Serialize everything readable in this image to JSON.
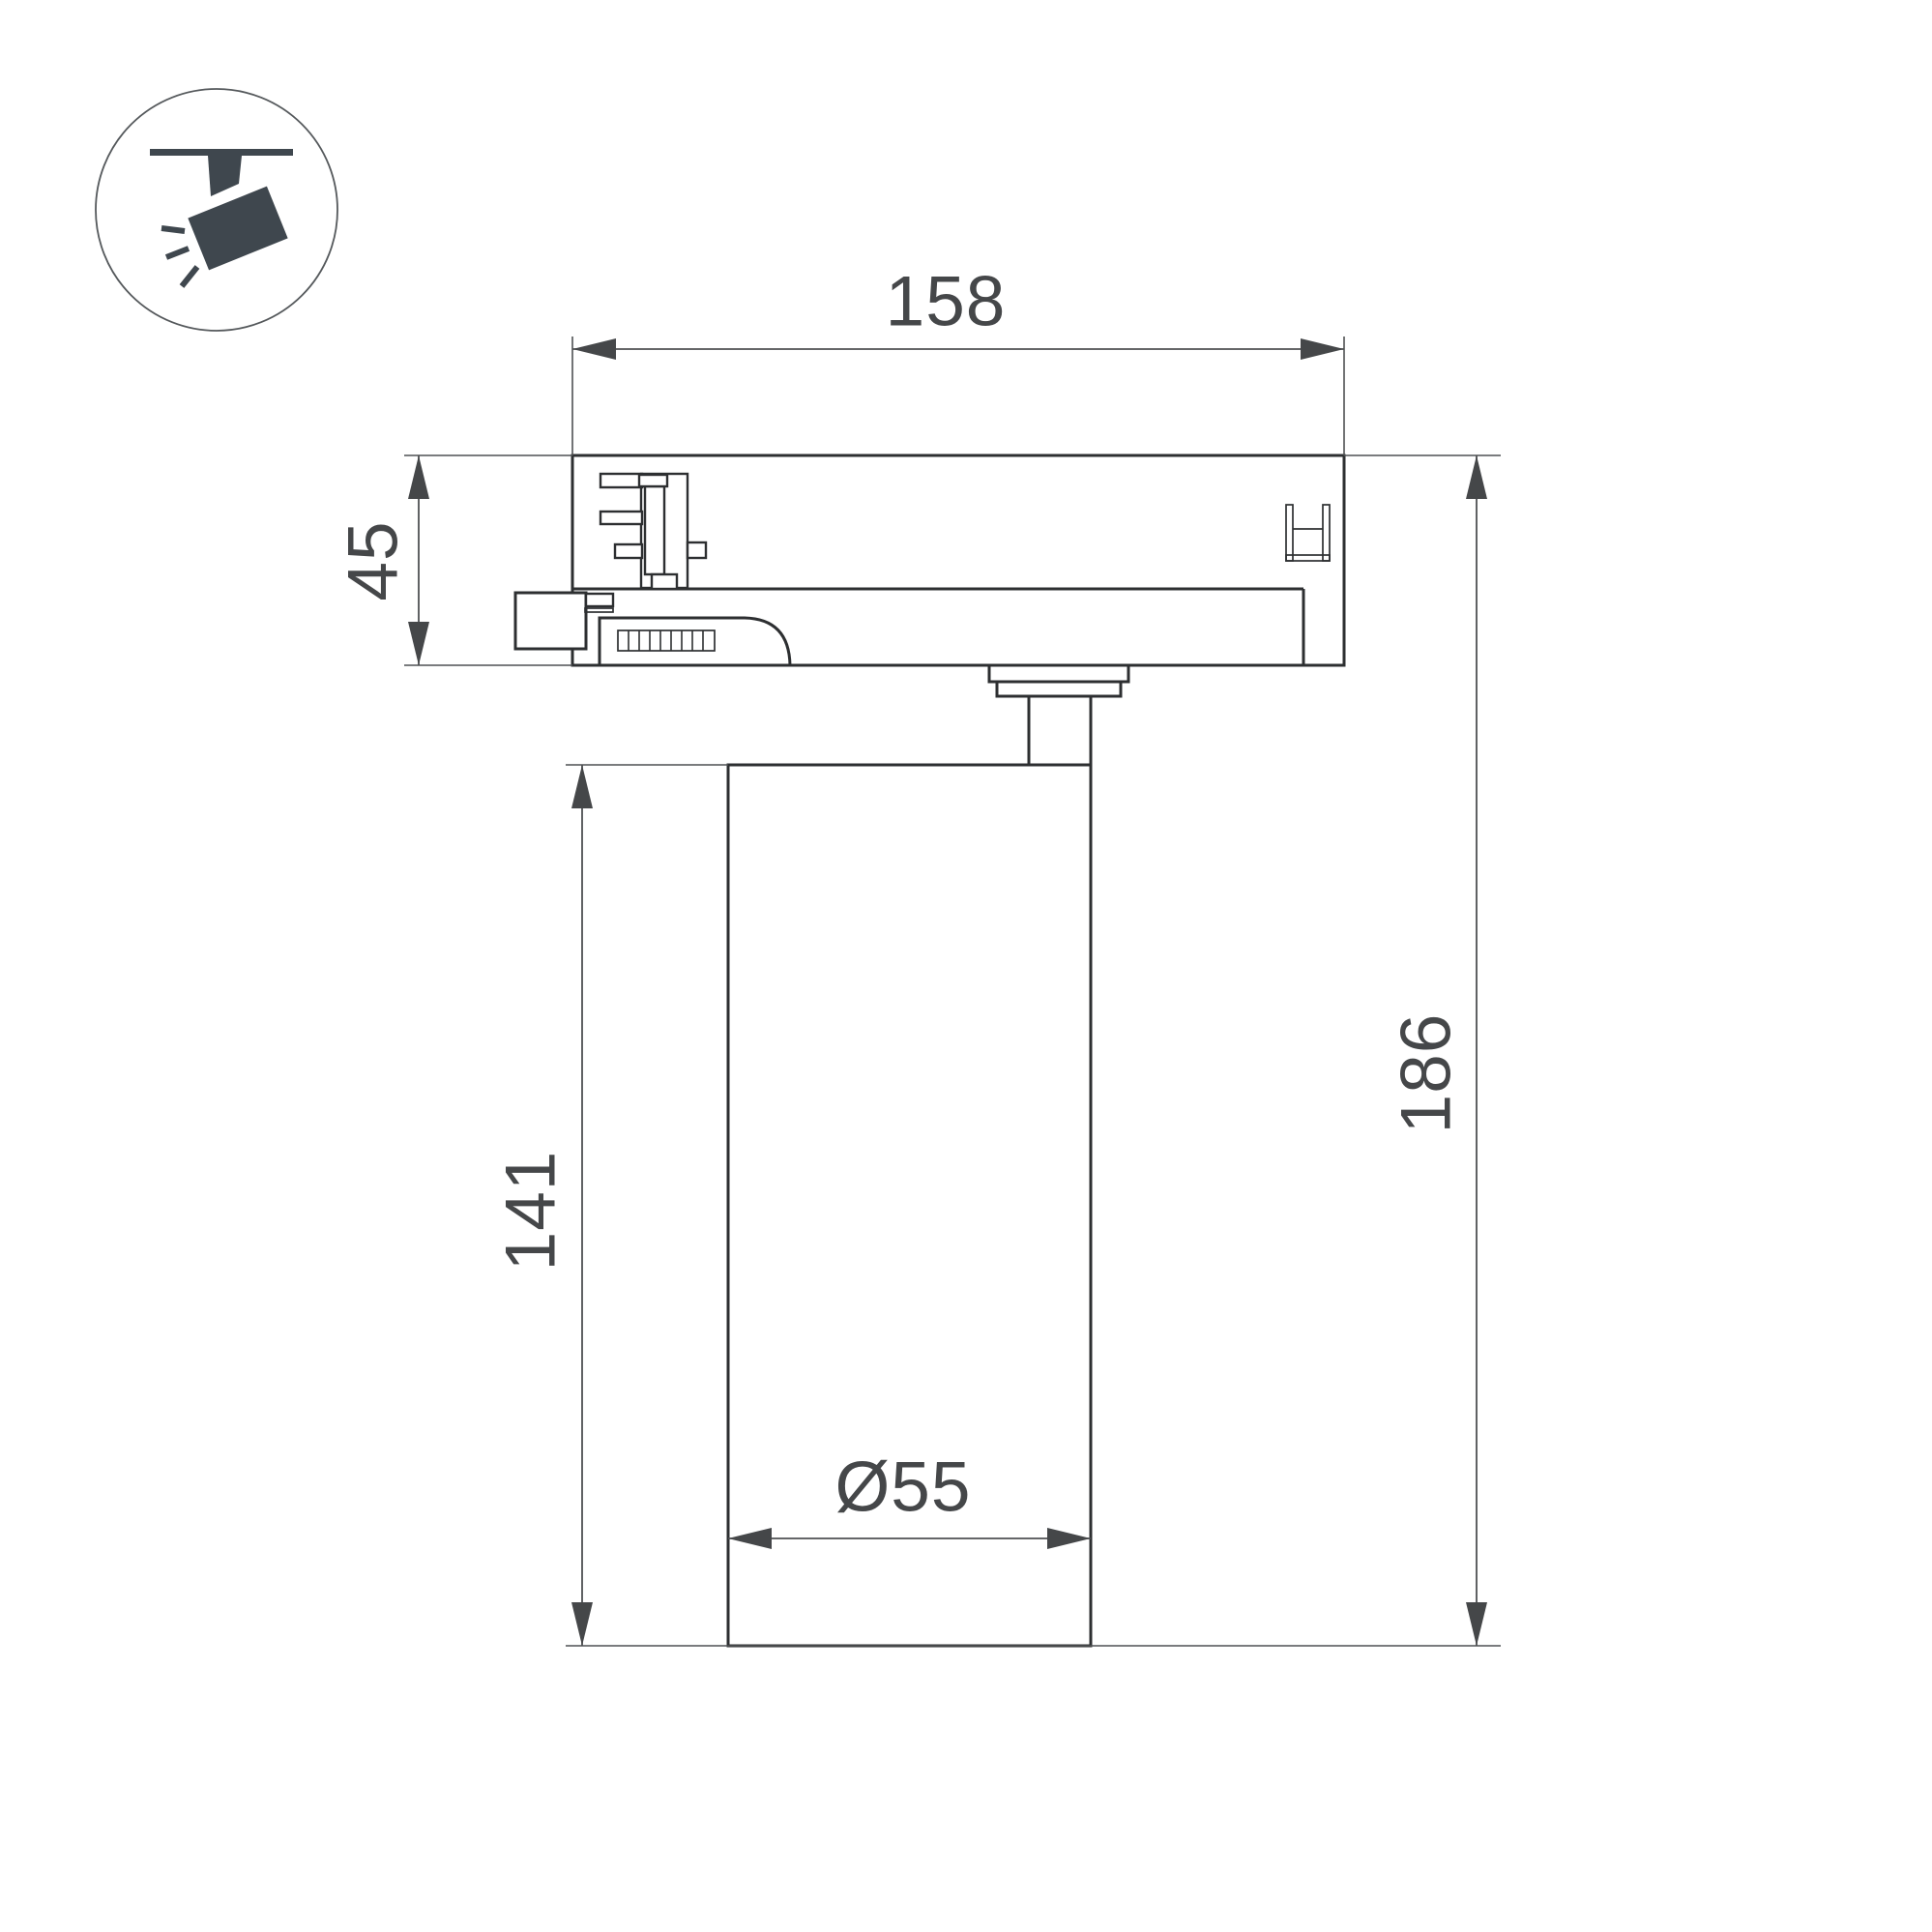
{
  "drawing": {
    "type": "technical-dimension-drawing",
    "subject": "track-mounted cylindrical spotlight, side section view",
    "dimensions": {
      "track_adapter_width": "158",
      "track_adapter_height": "45",
      "lamp_body_height": "141",
      "total_height": "186",
      "lamp_body_diameter": "Ø55"
    }
  },
  "icon": {
    "name": "track-spotlight-icon",
    "description": "ceiling track with tilted spotlight head and light rays, inside circle"
  },
  "colors": {
    "background": "#ffffff",
    "outline": "#2d2f31",
    "dimension_line": "#4f5153",
    "dimension_text": "#454749",
    "icon_fill": "#3f474e",
    "icon_circle_stroke": "#55595c"
  }
}
